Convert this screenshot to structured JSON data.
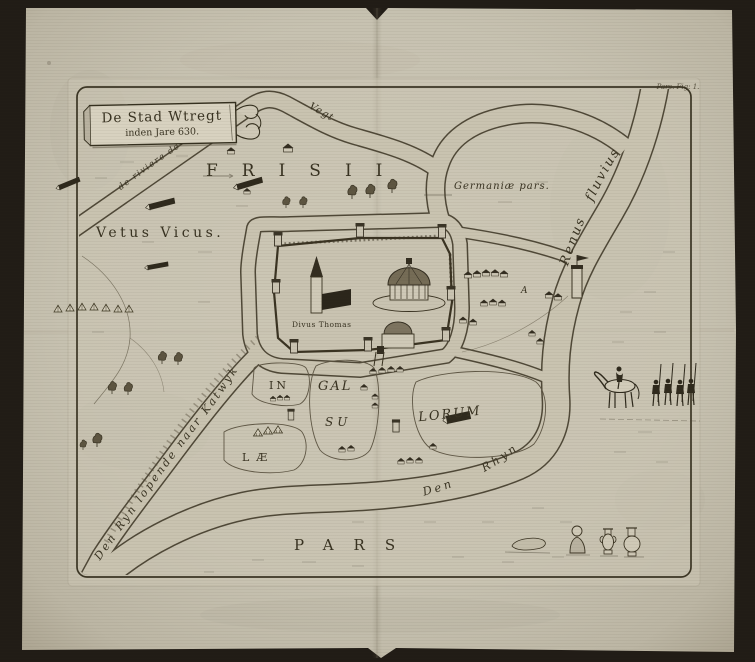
{
  "cartouche": {
    "line1": "De Stad Wtregt",
    "line2": "inden Jare 630."
  },
  "plate_caption": "Pars. Fig: 1.",
  "region_labels": {
    "frisii": "FRISII",
    "germaniae_pars": "Germaniæ pars.",
    "vetus_vicus": "Vetus Vicus.",
    "pars": "PARS",
    "marker_a": "A"
  },
  "river_labels": {
    "vegt": "Vegt",
    "de_riviere_de": "de riviere de",
    "renus_fluvius": "Renus fluvius",
    "den_rhyn": "Den Rhyn",
    "den_ryn_katwyk": "Den Ryn lopende naar Katwyk"
  },
  "city_labels": {
    "divus_thomas": "Divus Thomas"
  },
  "island_labels": {
    "in": "IN",
    "gal": "GAL",
    "su": "SU",
    "lorum": "LORUM",
    "lae": "LÆ"
  },
  "colors": {
    "paper": "#c7c2b1",
    "ink": "#3a3322",
    "water_edge": "#4f4837",
    "backdrop": "#211c16"
  }
}
